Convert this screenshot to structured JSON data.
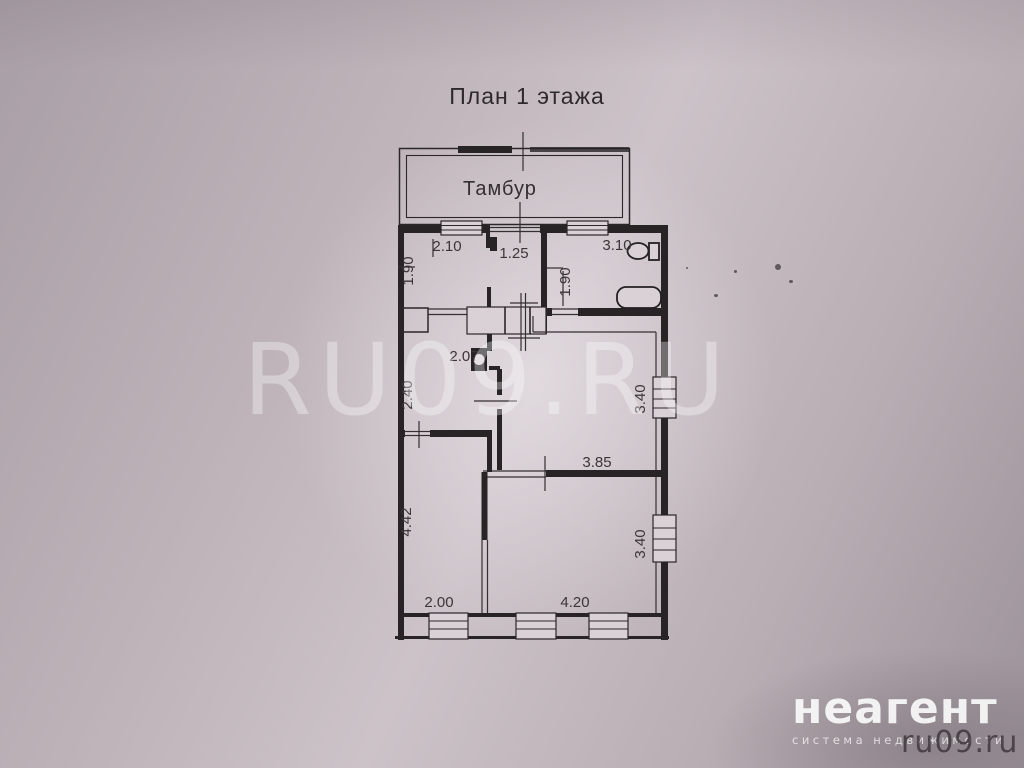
{
  "title": "План 1 этажа",
  "plan": {
    "rooms": {
      "vestibule": "Тамбур"
    },
    "dimensions": {
      "hall_width": "2.10",
      "entry_width": "1.25",
      "bath_width": "3.10",
      "hall_depth": "1.90",
      "bath_depth": "1.90",
      "kitchen_width": "2.07",
      "kitchen_depth": "2.40",
      "living_depth": "3.40",
      "living_width": "3.85",
      "left_room_depth": "4.42",
      "right_room_depth": "3.40",
      "left_room_width": "2.00",
      "right_room_width": "4.20"
    }
  },
  "watermark": "RU09.RU",
  "branding": {
    "logo": "неагент",
    "tagline": "система недвижимости",
    "site": "ru09.ru"
  }
}
